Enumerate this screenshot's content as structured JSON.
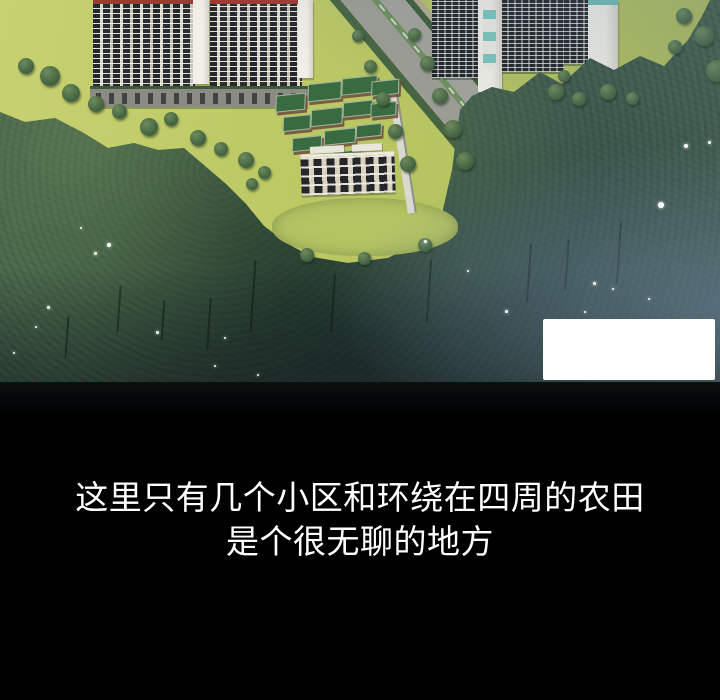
{
  "panel": {
    "type": "webtoon-panel",
    "illustration_alt": "Aerial rendering of a residential complex: white high-rise apartment slabs, low-rise green-roofed buildings, a tree-lined diagonal road, yellow-green fields and dense surrounding forest fading into darkness",
    "caption_box": {
      "text": ""
    },
    "dialogue": {
      "line1": "这里只有几个小区和环绕在四周的农田",
      "line2": "是个很无聊的地方"
    },
    "colors": {
      "background": "#000000",
      "text": "#ffffff",
      "caption_box": "#ffffff",
      "field_green": "#c3cd6b",
      "forest_green": "#44624a",
      "forest_blue_tint": "#6a7e98",
      "roof_red": "#9e3a30",
      "roof_green": "#3a6b40",
      "teal_accent": "#7cc7bf",
      "road_gray": "#9d9d94",
      "building_white": "#e9e7e0",
      "window_dark": "#25282b"
    }
  }
}
